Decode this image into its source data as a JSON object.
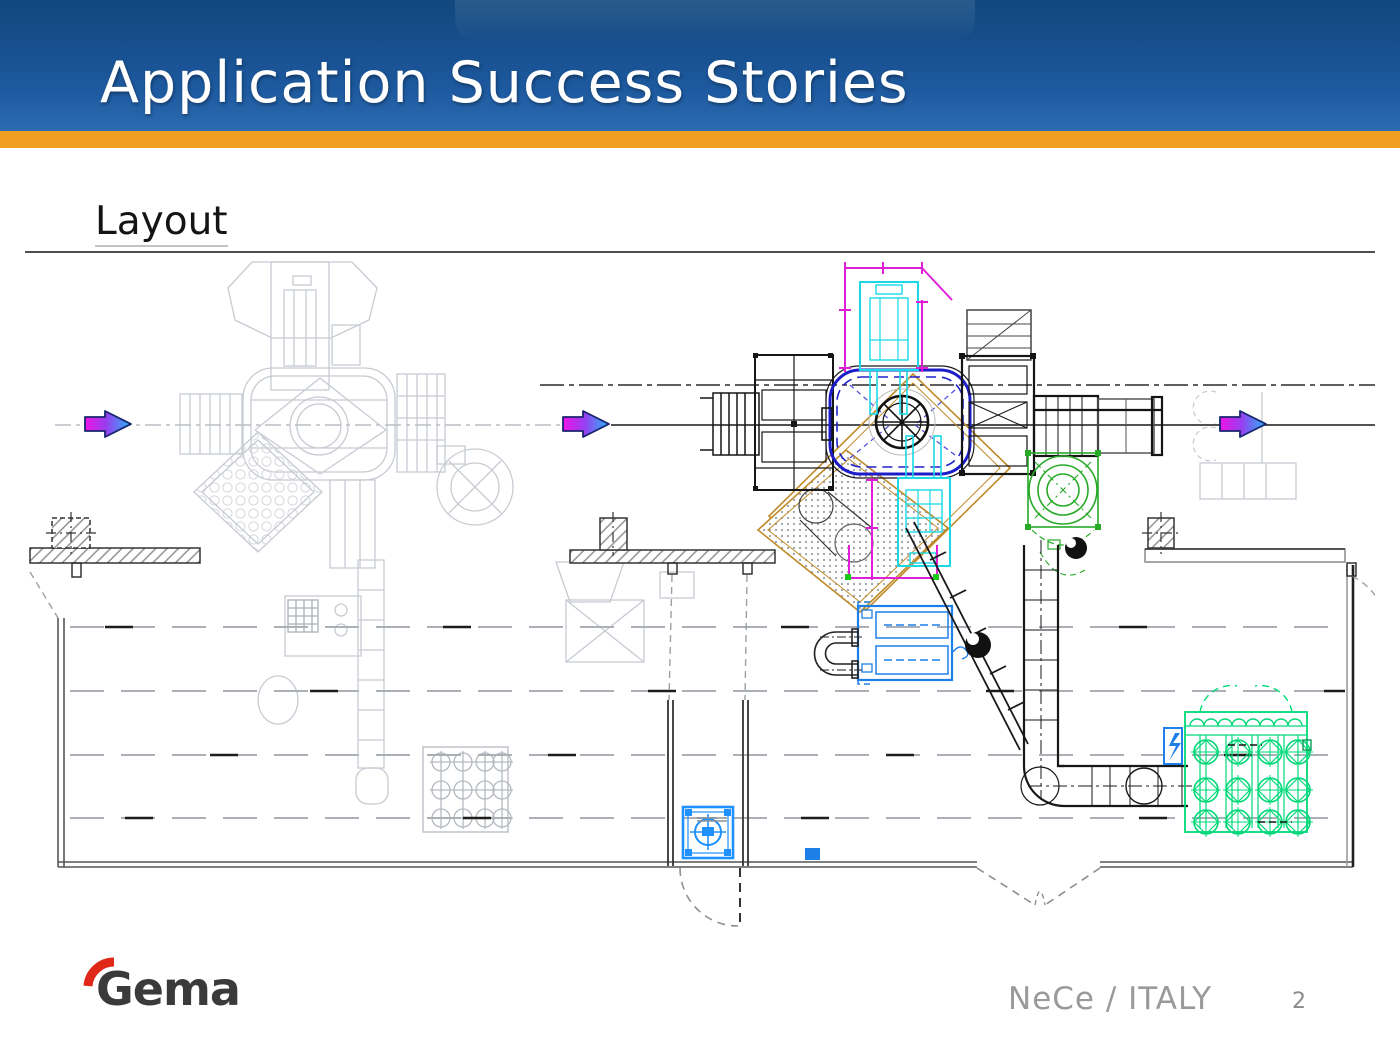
{
  "slide": {
    "header": {
      "title": "Application Success Stories"
    },
    "section": {
      "heading": "Layout"
    },
    "footer": {
      "project": "NeCe / ITALY",
      "page_number": "2",
      "logo_text": "Gema"
    }
  },
  "diagram": {
    "name": "plant-layout-cad-drawing",
    "colors": {
      "ghost_equipment_gray": "#c7cbd2",
      "conveyor_loop_navy": "#1c1cc8",
      "pretreatment_cyan": "#1ad8e4",
      "dimension_magenta": "#e020d8",
      "platform_tan": "#c08a28",
      "cyclone_green": "#28aa28",
      "afterfilter_green": "#00d878",
      "equipment_blue": "#1f7fe8",
      "flow_arrow_start": "#ee14e6",
      "flow_arrow_end": "#28b4f6",
      "wall_dark": "#333333",
      "header_blue": "#1e5aa0",
      "accent_orange": "#f29e22",
      "logo_red": "#e02818"
    }
  }
}
